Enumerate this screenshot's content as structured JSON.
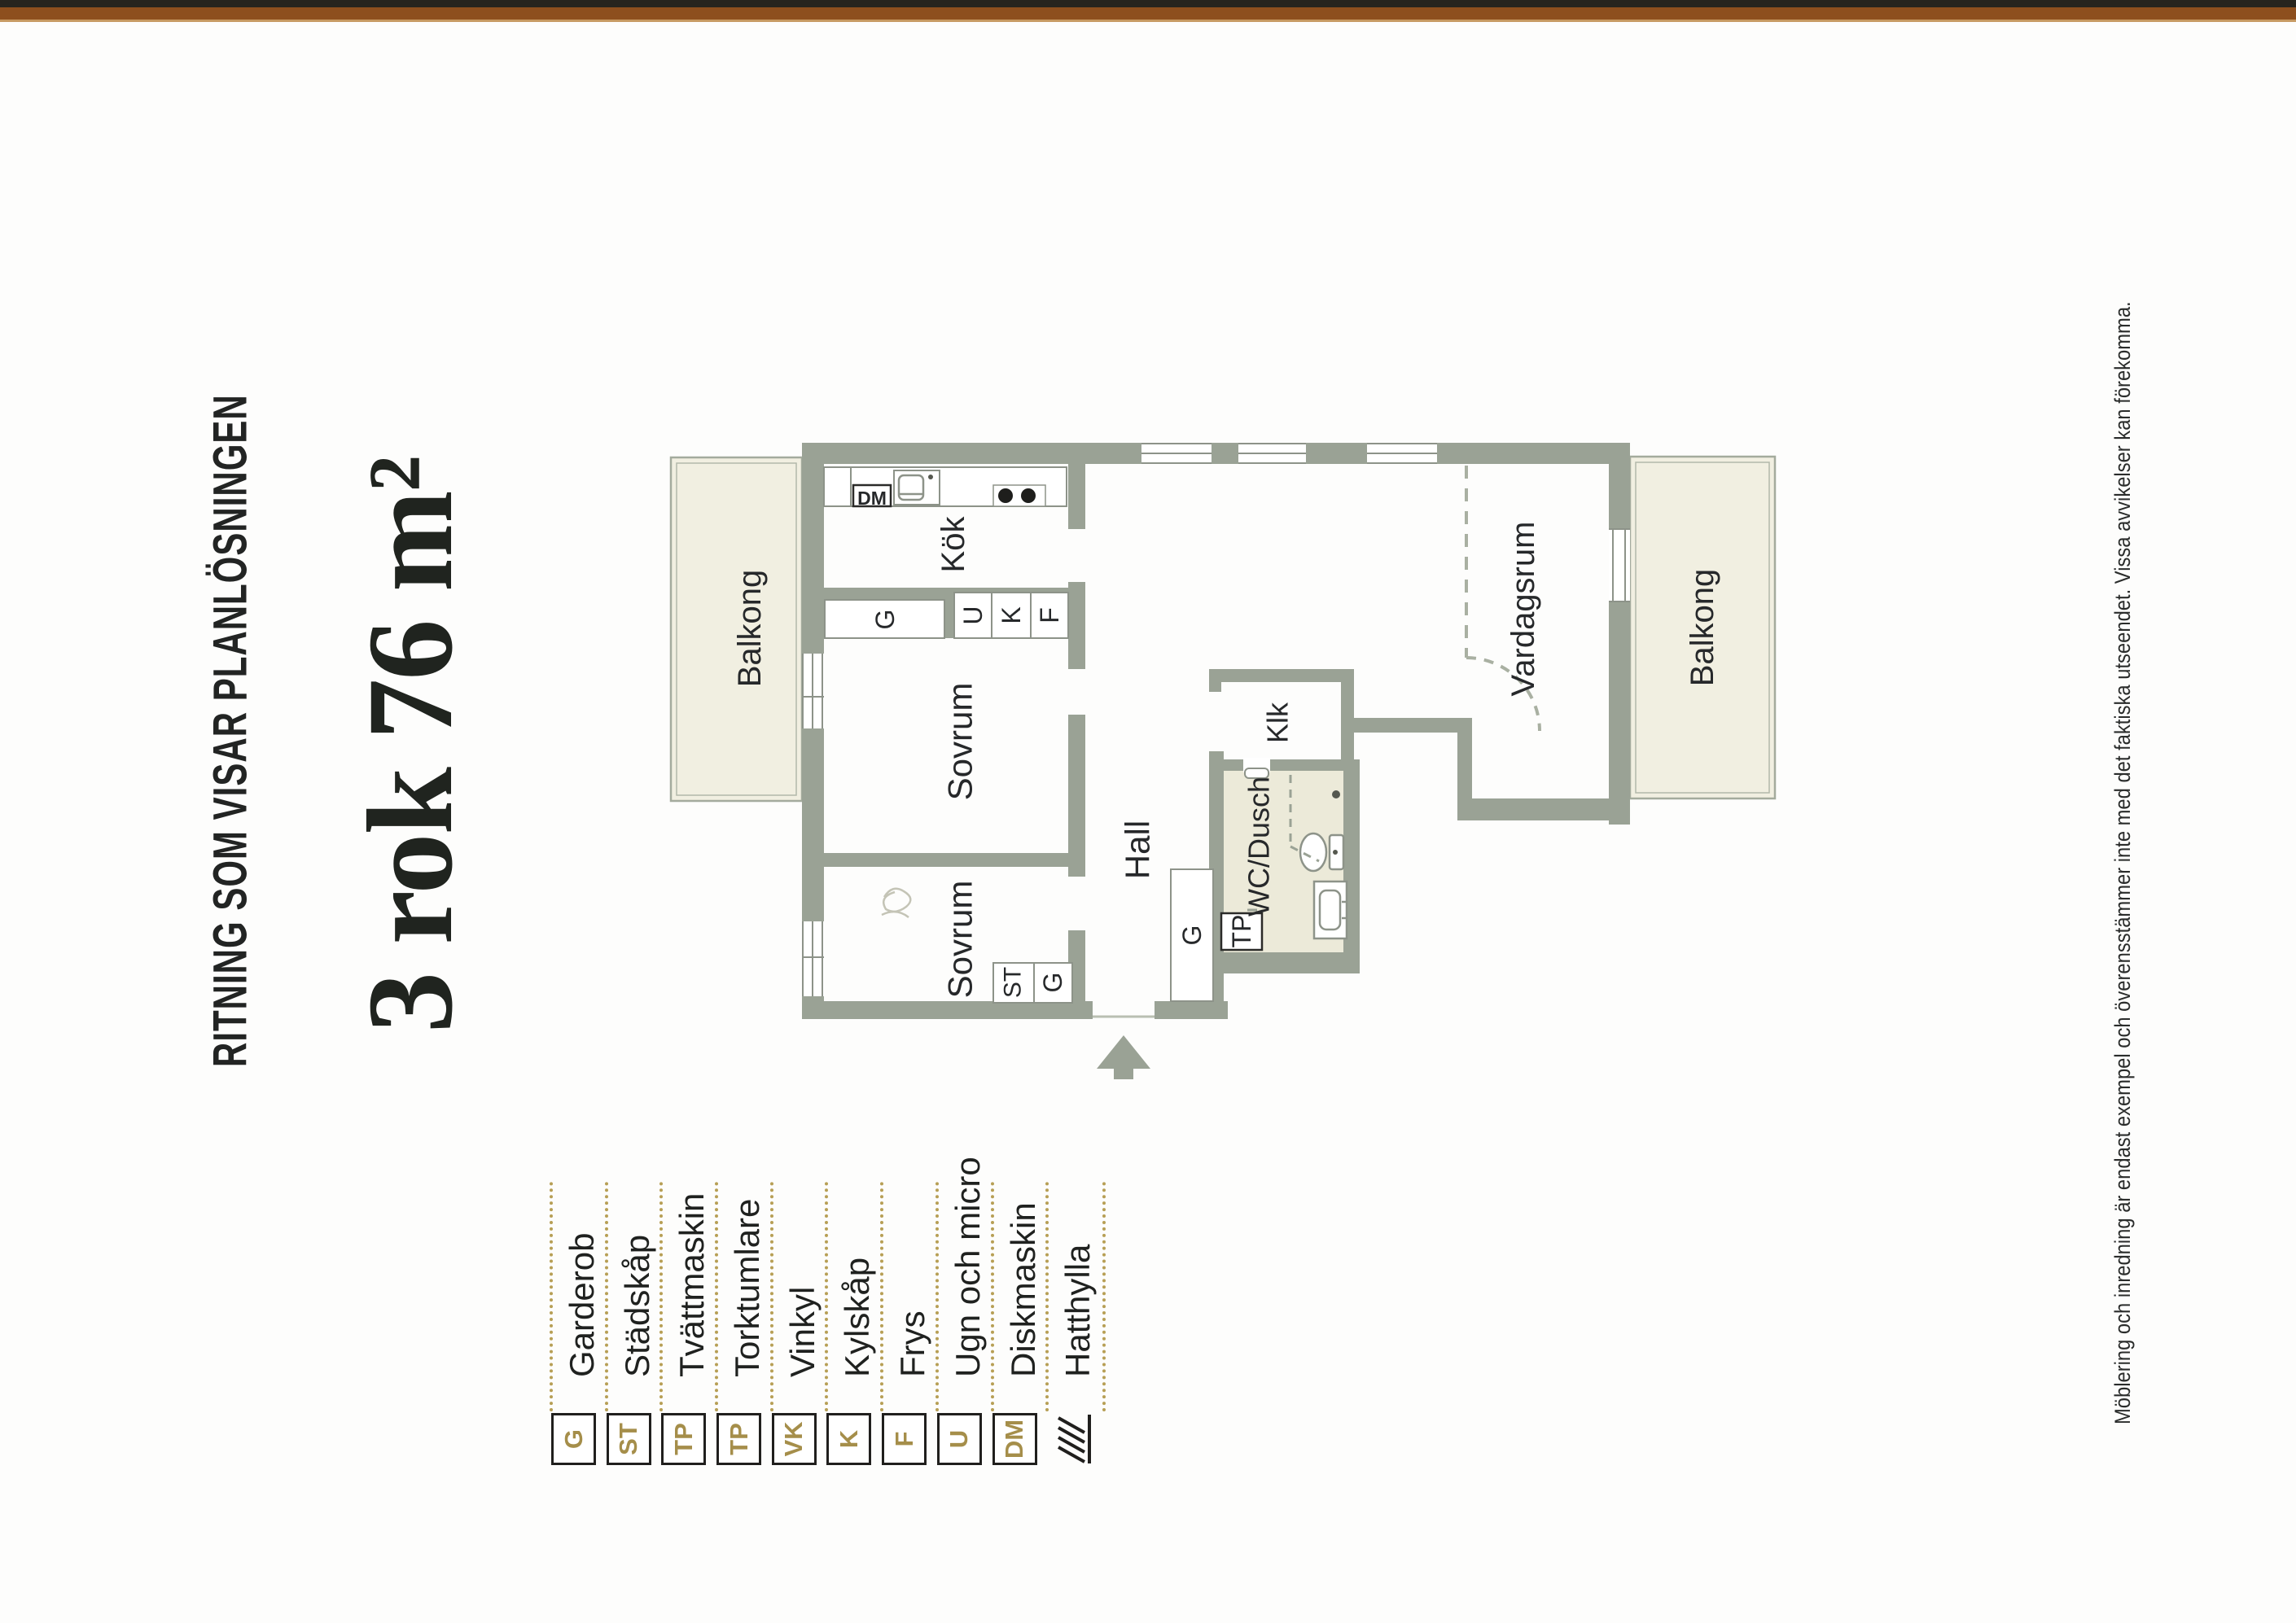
{
  "page": {
    "title": "RITNING SOM VISAR PLANLÖSNINGEN",
    "headline": "3 rok 76 m²",
    "disclaimer": "Möblering och inredning är endast exempel och överensstämmer inte med det faktiska utseendet. Vissa avvikelser kan förekomma."
  },
  "legend": {
    "items": [
      {
        "code": "G",
        "label": "Garderob"
      },
      {
        "code": "ST",
        "label": "Städskåp"
      },
      {
        "code": "TP",
        "label": "Tvättmaskin"
      },
      {
        "code": "TP",
        "label": "Torktumlare"
      },
      {
        "code": "VK",
        "label": "Vinkyl"
      },
      {
        "code": "K",
        "label": "Kylskåp"
      },
      {
        "code": "F",
        "label": "Frys"
      },
      {
        "code": "U",
        "label": "Ugn och micro"
      },
      {
        "code": "DM",
        "label": "Diskmaskin"
      },
      {
        "code": "",
        "label": "Hatthylla"
      }
    ]
  },
  "plan": {
    "labels": {
      "balkong_left": "Balkong",
      "balkong_right": "Balkong",
      "kok": "Kök",
      "sovrum_upper": "Sovrum",
      "sovrum_lower": "Sovrum",
      "hall": "Hall",
      "vardagsrum": "Vardagsrum",
      "klk": "Klk",
      "wc_dusch": "WC/Dusch",
      "garderob_kok": "G",
      "ugn": "U",
      "kyl": "K",
      "frys": "F",
      "stadskap": "ST",
      "garderob_sovrum": "G",
      "garderob_hall": "G",
      "tvattpelare": "TP",
      "diskmaskin": "DM"
    }
  },
  "colors": {
    "wall": "#9aa295",
    "balcony_floor": "#f1efe1",
    "bathroom_floor": "#ecead9",
    "legend_gold": "#a58e4a",
    "edge_brown": "#8d4f1e",
    "text": "#242624"
  }
}
